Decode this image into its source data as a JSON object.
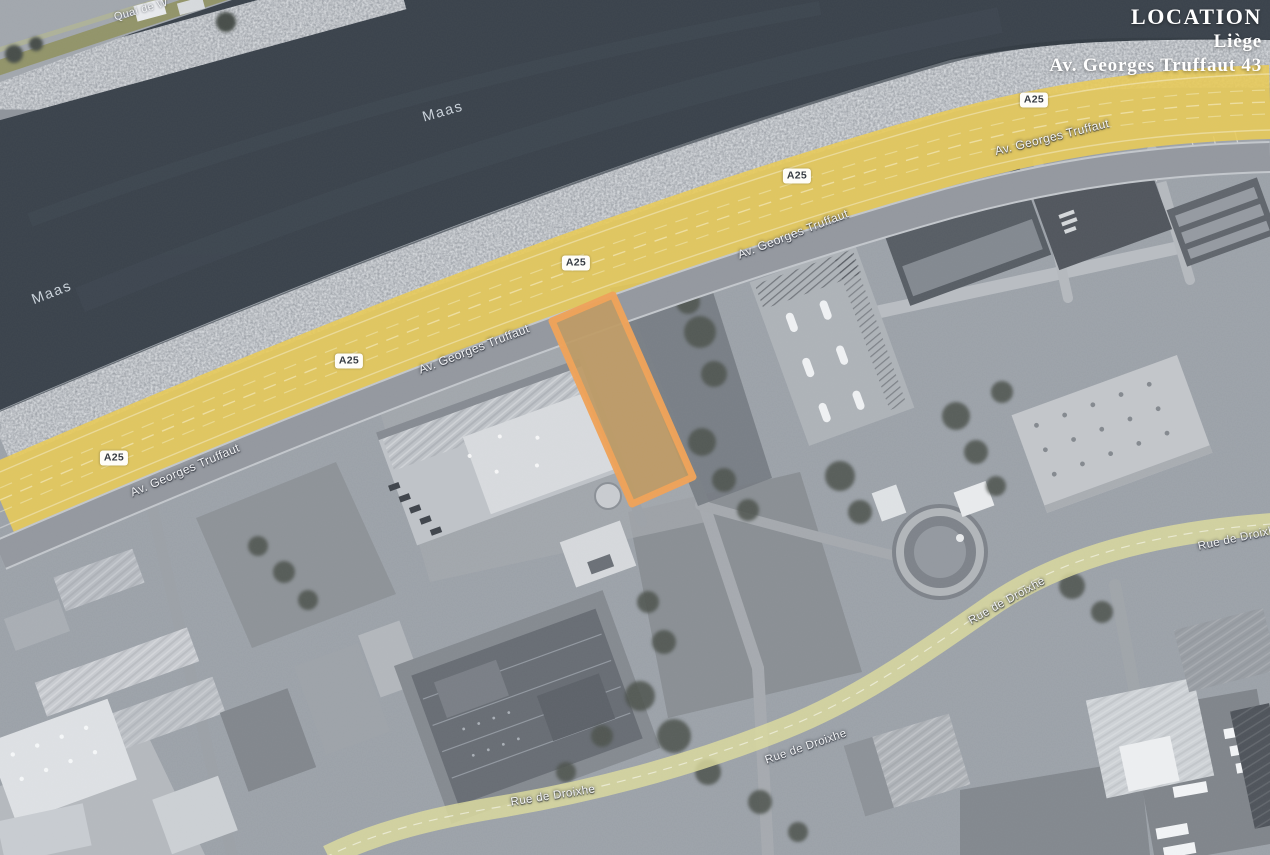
{
  "location_panel": {
    "title": "LOCATION",
    "city": "Liège",
    "address": "Av. Georges Truffaut 43"
  },
  "map_labels": {
    "river": [
      {
        "text": "Maas"
      },
      {
        "text": "Maas"
      }
    ],
    "quai": {
      "text": "Quai de W"
    },
    "motorway_badges": [
      {
        "text": "A25"
      },
      {
        "text": "A25"
      },
      {
        "text": "A25"
      },
      {
        "text": "A25"
      },
      {
        "text": "A25"
      }
    ],
    "avenue": [
      {
        "text": "Av. Georges Truffaut"
      },
      {
        "text": "Av. Georges Truffaut"
      },
      {
        "text": "Av. Georges Truffaut"
      },
      {
        "text": "Av. Georges Truffaut"
      }
    ],
    "rue": [
      {
        "text": "Rue de Droixhe"
      },
      {
        "text": "Rue de Droixhe"
      },
      {
        "text": "Rue de Droixhe"
      },
      {
        "text": "Rue de Droixhe"
      }
    ]
  },
  "colors": {
    "water": "#3a424b",
    "land": "#9aa0a7",
    "motorway_highlight": "#e9cb55",
    "secondary_highlight": "#dddc9e",
    "quai_highlight": "#8e9057",
    "parcel_border": "#f0a258",
    "parcel_fill": "#bf9a63",
    "label_text": "#f3f4f6"
  }
}
